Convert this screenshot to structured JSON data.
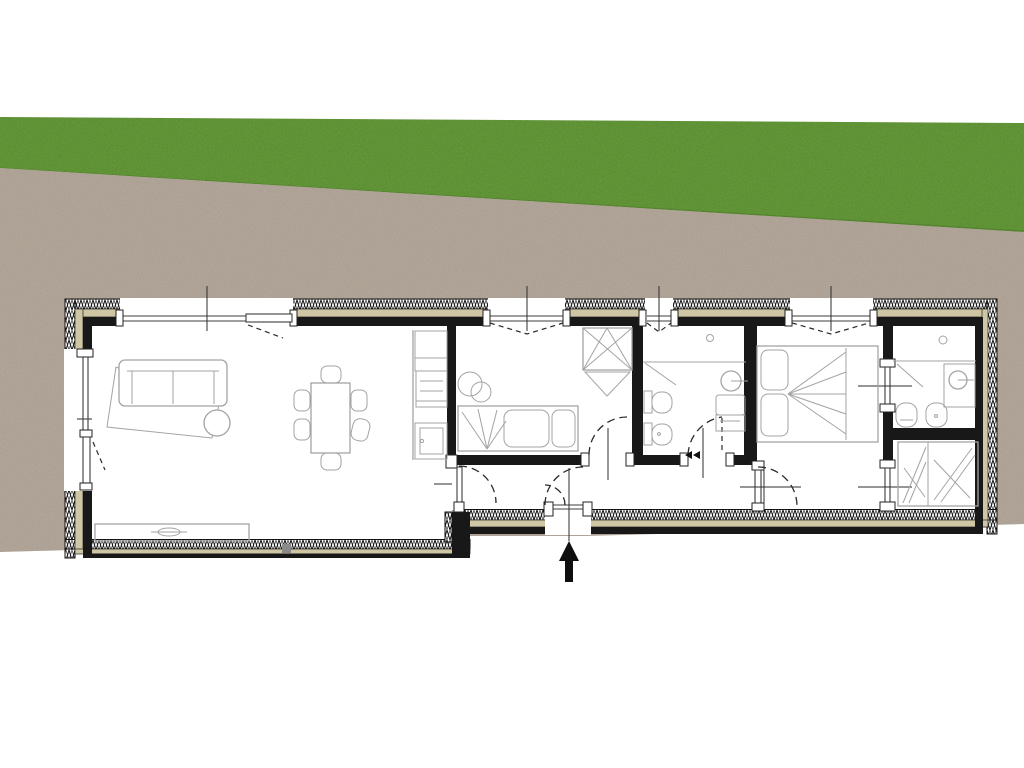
{
  "title": "Apartment floor plan over site photo",
  "colors": {
    "grass": "#6aa23c",
    "grassEdge": "#4b772a",
    "ground": "#b8ab9e",
    "wallTan": "#cfc6a6",
    "wallBlack": "#181818",
    "fur": "#a3a3a3",
    "arrow": "#0f0f0f"
  },
  "background": {
    "areas": [
      {
        "name": "lawn",
        "texture": "grass"
      },
      {
        "name": "gravel-strip",
        "texture": "dirt"
      },
      {
        "name": "page-white",
        "texture": "plain"
      }
    ]
  },
  "plan": {
    "entrance": {
      "symbol": "up-arrow"
    },
    "rooms": [
      {
        "name": "living-room",
        "furniture": [
          "corner-sofa",
          "rug",
          "ottoman",
          "dining-table",
          "dining-chairs",
          "sideboard",
          "kitchen-counter"
        ]
      },
      {
        "name": "bedroom-single",
        "furniture": [
          "single-bed",
          "side-tables",
          "built-in-wardrobe"
        ]
      },
      {
        "name": "hallway",
        "furniture": []
      },
      {
        "name": "bathroom-1",
        "furniture": [
          "washbasin",
          "wc",
          "bidet",
          "shower-cabinet"
        ]
      },
      {
        "name": "bedroom-double",
        "furniture": [
          "double-bed"
        ]
      },
      {
        "name": "bathroom-2",
        "furniture": [
          "washbasin",
          "wc",
          "bidet",
          "shower-screen"
        ]
      },
      {
        "name": "walk-in-closet",
        "furniture": [
          "wardrobe"
        ]
      }
    ]
  }
}
